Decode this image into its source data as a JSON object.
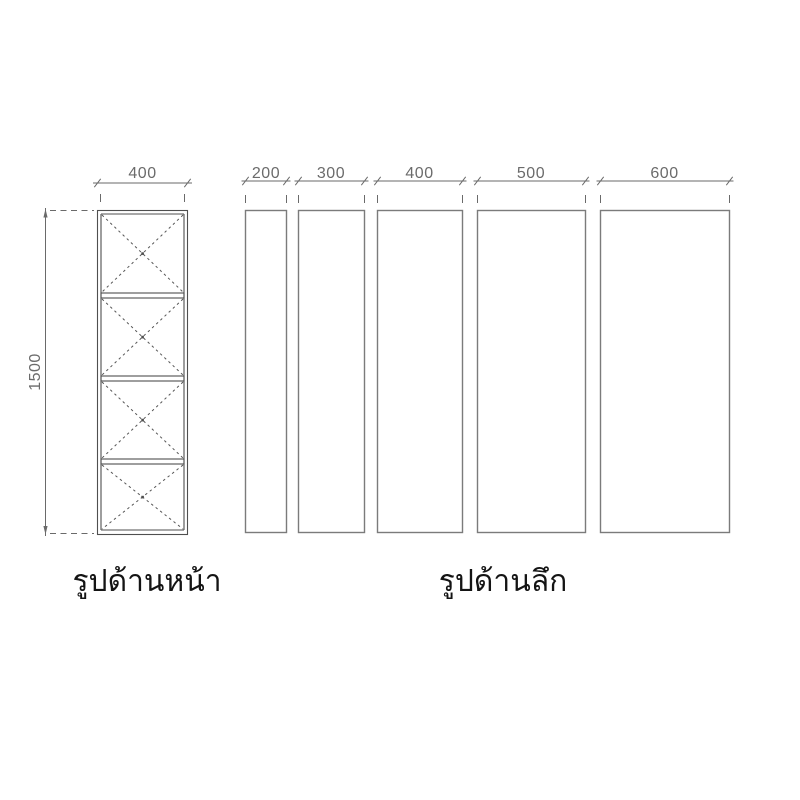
{
  "drawing": {
    "front_view": {
      "caption": "รูปด้านหน้า",
      "width_label": "400",
      "width_mm": 400,
      "height_label": "1500",
      "height_mm": 1500,
      "compartment_count": 4,
      "compartment_marking": "dashed-x-brace"
    },
    "depth_view": {
      "caption": "รูปด้านลึก",
      "panels": [
        {
          "width_label": "200",
          "width_mm": 200
        },
        {
          "width_label": "300",
          "width_mm": 300
        },
        {
          "width_label": "400",
          "width_mm": 400
        },
        {
          "width_label": "500",
          "width_mm": 500
        },
        {
          "width_label": "600",
          "width_mm": 600
        }
      ]
    },
    "colors": {
      "background": "#ffffff",
      "cabinet_line": "#4f4f4f",
      "panel_line": "#7b7b7b",
      "dimension_line": "#6a6a6a",
      "dimension_text": "#6b6b6b",
      "caption_text": "#141414"
    }
  }
}
